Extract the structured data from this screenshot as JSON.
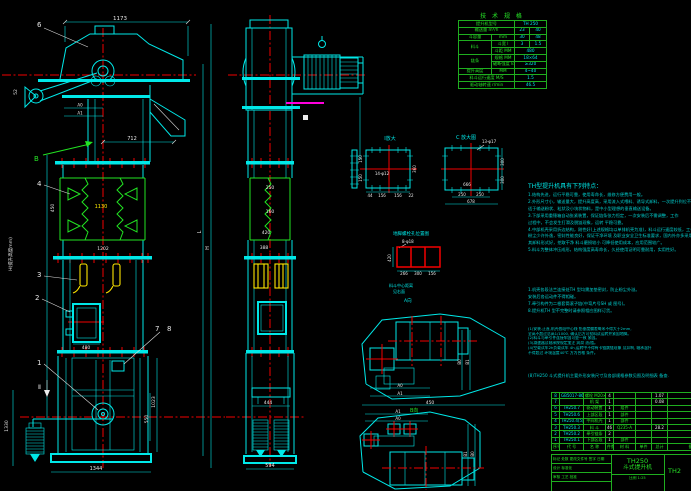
{
  "colors": {
    "background": "#000000",
    "line_cyan": "#00e8e8",
    "line_green": "#22e422",
    "line_red": "#f20000",
    "line_yellow": "#ffe600",
    "line_magenta": "#ff00dd",
    "text_white": "#e8e8e8"
  },
  "svg": {
    "d1173": "1173",
    "d712": "712",
    "d52": "52",
    "a0": "A0",
    "a1": "A1",
    "n6": "6",
    "vb": "B",
    "h_label": "H(提升高度mm)",
    "d450": "450",
    "d1130": "1130",
    "d1202": "1202",
    "n4": "4",
    "n3": "3",
    "n2": "2",
    "n1": "1",
    "d480": "480",
    "n7": "7",
    "n8": "8",
    "sec2": "Ⅱ",
    "d1330": "1330",
    "d1344": "1344",
    "d1023": "1023",
    "d550": "550",
    "dL": "L",
    "dH": "H",
    "s250": "250",
    "s160": "160",
    "s420": "420",
    "s388": "388",
    "s444": "444",
    "s594": "594",
    "det1_label": "Ⅰ放大",
    "det1_holes": "14-φ12",
    "det1_150a": "150",
    "det1_150b": "150",
    "det1_360": "360",
    "det1_b1": "44",
    "det1_b2": "156",
    "det1_b3": "156",
    "det1_b4": "22",
    "detc_label": "C 放大图",
    "detc_holes": "13-φ17",
    "detc_666": "666",
    "detc_250a": "250",
    "detc_250b": "250",
    "detc_678": "678",
    "detc_300a": "300",
    "detc_300b": "300",
    "grid_title": "地脚螺栓孔位置图",
    "grid_holes": "8-φ18",
    "grid_420": "420",
    "grid_266": "266",
    "grid_300": "300",
    "grid_156": "156",
    "note_a": "料斗中心距离",
    "note_b": "见右面",
    "note_c": "A向",
    "p1_a0": "A0",
    "p1_a1": "A1",
    "p1_b0": "B0",
    "p1_b1": "B1",
    "p1_450": "450",
    "p2_a1": "A1",
    "p2_a0": "A0",
    "p2_b1": "B1",
    "p2_b0": "B0",
    "p2_label": "B向"
  },
  "spec": {
    "title": "技 术 规 格",
    "r1a": "提升机型号",
    "r1b": "TH 250",
    "r2a": "输送量 m³/h",
    "r2c": "23",
    "r2d": "40",
    "r3a": "斗容量",
    "r3b": "mm",
    "r3c": "30",
    "r3d": "48",
    "r4a": "料斗",
    "r4b": "斗宽 l",
    "r4c": "3",
    "r4d": "1.5",
    "r5b": "斗距 MM",
    "r5c": "480",
    "r6a": "链条",
    "r6b": "规格 MM",
    "r6c": "18×64",
    "r7b": "破断强度 kN",
    "r7c": "≥320",
    "r8a": "提升高度",
    "r8b": "MM",
    "r8c": "4~40",
    "r9a": "料斗运行速度 M/S",
    "r9c": "1.5",
    "r10a": "驱动轴转速 r/min",
    "r10c": "46.5"
  },
  "notes": {
    "title": "TH型提升机具有下列特点：",
    "g1": [
      "1.结构先进，运行平稳可靠，使用寿命长，维修方便费用一般。",
      "2.外形尺寸小，输送量大，提升高度高，采用流入式喂料、诱导式卸料，一次提升到位不反弹，",
      "  适于输送粉状、粒状及小块状物料，是中小型理想的垂直输送设备。",
      "3.下部采用重锤箱自动张紧装置，保证链条张力恒定，一次安装后不需调整，工作",
      "  过程中，不会发生打滑及脱链现象，运转 平稳可靠。",
      "4.中部机壳采用折边结构，刚性好(上述规格均以单排机壳为准)，料斗运行速度较低，工作噪声较小，",
      "  粉尘少许外逸，密封性能良好，保证干净环境 及职业安全卫生标准要求，国内外亦多采用，",
      "  其卸料形式好，挖取干净 料斗磨损较小 可降低使用成本，应用范围较广。",
      "5.料斗为整体冲压成形，结构强度高寿命长，久经使用证明可靠耐用，实用性好。"
    ],
    "g2": [
      "1.机壳各段法兰连接处TH 型均需加垫密封，防止粉尘外溢。",
      "  安装后各运动件不得相碰。",
      "7.牵引构件为二根套筒滚子链(中弯片号SH 或 图号)。",
      "8.提升机TH 型不完整时请参照相应图样订货。"
    ],
    "g3": [
      "(1)安装.正直,机壳各段中心线 铅垂度偏差每米不得大于2mm,",
      "  全高不超过总高1/1000, 确认后方可投料试运转并紧固地脚。",
      "(2)料斗与牵引件连接牢固可靠一致 紧固。",
      "(3)减速器及轴承按规定加注 润滑 油/脂。",
      "(4)空载试车2h负载试车 4h,运转中不得有卡链跳链现象 及异响, 轴承温升",
      "  不得超过 环境温度40℃ 方为合格 条件。"
    ],
    "g4": [
      "(8)TH250 斗式提升机主要外形安装尺寸及各部规格参数见图及明细表 备查."
    ]
  },
  "bom": {
    "rows": [
      {
        "n": "8",
        "c": "GB5017-86",
        "m": "螺栓 M20×85",
        "q": "4",
        "mt": "",
        "w1": "",
        "w2": "1.07",
        "rm": ""
      },
      {
        "n": "7",
        "c": "",
        "m": "机  架",
        "q": "1",
        "mt": "",
        "w1": "",
        "w2": "0.08",
        "rm": ""
      },
      {
        "n": "6",
        "c": "TH250.7",
        "m": "驱动装置",
        "q": "1",
        "mt": "组件",
        "w1": "",
        "w2": "",
        "rm": ""
      },
      {
        "n": "5",
        "c": "TH250.6",
        "m": "上部区段",
        "q": "1",
        "mt": "部件",
        "w1": "",
        "w2": "",
        "rm": ""
      },
      {
        "n": "4",
        "c": "TH250.4(5)",
        "m": "中间机壳",
        "q": "1",
        "mt": "部件",
        "w1": "",
        "w2": "",
        "rm": ""
      },
      {
        "n": "3",
        "c": "TH250.3",
        "m": "料  斗",
        "q": "46",
        "mt": "Q235-A",
        "w1": "",
        "w2": "28.2",
        "rm": ""
      },
      {
        "n": "2",
        "c": "TH250.2",
        "m": "牵引链条",
        "q": "2",
        "mt": "",
        "w1": "",
        "w2": "",
        "rm": ""
      },
      {
        "n": "1",
        "c": "TH250.1",
        "m": "下部区段",
        "q": "1",
        "mt": "部件",
        "w1": "",
        "w2": "",
        "rm": ""
      }
    ],
    "header": {
      "n": "序号",
      "c": "代  号",
      "m": "名  称",
      "q": "件数",
      "mt": "材  料",
      "w1": "单件",
      "w2": "总计",
      "rm": "备注"
    }
  },
  "title_block": {
    "l1": "标记 处数 更改文件号 签字 日期",
    "l2": "设计      标准化",
    "l3": "审核  工艺    批准",
    "model": "TH250",
    "name": "斗式提升机",
    "scale": "比例 1:25",
    "drawing_no": "TH2"
  }
}
